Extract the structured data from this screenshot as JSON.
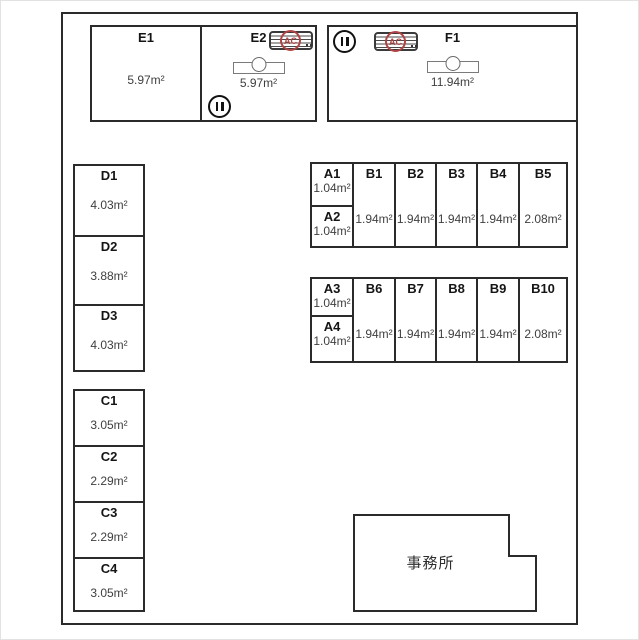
{
  "plan_name": "storage-unit-floor-plan",
  "office": {
    "label": "事務所"
  },
  "icons": {
    "ac_label": "AC",
    "ac_name": "air-conditioner-icon",
    "shutter_name": "shutter-circle-icon",
    "fixture_name": "sink-fixture-icon"
  },
  "colors": {
    "wall": "#2b2b2b",
    "ac_red": "#b04343",
    "label_text": "#151515",
    "area_text": "#3f3f3f"
  },
  "units": {
    "E1": {
      "label": "E1",
      "area": "5.97m²"
    },
    "E2": {
      "label": "E2",
      "area": "5.97m²"
    },
    "F1": {
      "label": "F1",
      "area": "11.94m²"
    },
    "D1": {
      "label": "D1",
      "area": "4.03m²"
    },
    "D2": {
      "label": "D2",
      "area": "3.88m²"
    },
    "D3": {
      "label": "D3",
      "area": "4.03m²"
    },
    "C1": {
      "label": "C1",
      "area": "3.05m²"
    },
    "C2": {
      "label": "C2",
      "area": "2.29m²"
    },
    "C3": {
      "label": "C3",
      "area": "2.29m²"
    },
    "C4": {
      "label": "C4",
      "area": "3.05m²"
    },
    "A1": {
      "label": "A1",
      "area": "1.04m²"
    },
    "A2": {
      "label": "A2",
      "area": "1.04m²"
    },
    "A3": {
      "label": "A3",
      "area": "1.04m²"
    },
    "A4": {
      "label": "A4",
      "area": "1.04m²"
    },
    "B1": {
      "label": "B1",
      "area": "1.94m²"
    },
    "B2": {
      "label": "B2",
      "area": "1.94m²"
    },
    "B3": {
      "label": "B3",
      "area": "1.94m²"
    },
    "B4": {
      "label": "B4",
      "area": "1.94m²"
    },
    "B5": {
      "label": "B5",
      "area": "2.08m²"
    },
    "B6": {
      "label": "B6",
      "area": "1.94m²"
    },
    "B7": {
      "label": "B7",
      "area": "1.94m²"
    },
    "B8": {
      "label": "B8",
      "area": "1.94m²"
    },
    "B9": {
      "label": "B9",
      "area": "1.94m²"
    },
    "B10": {
      "label": "B10",
      "area": "2.08m²"
    }
  }
}
